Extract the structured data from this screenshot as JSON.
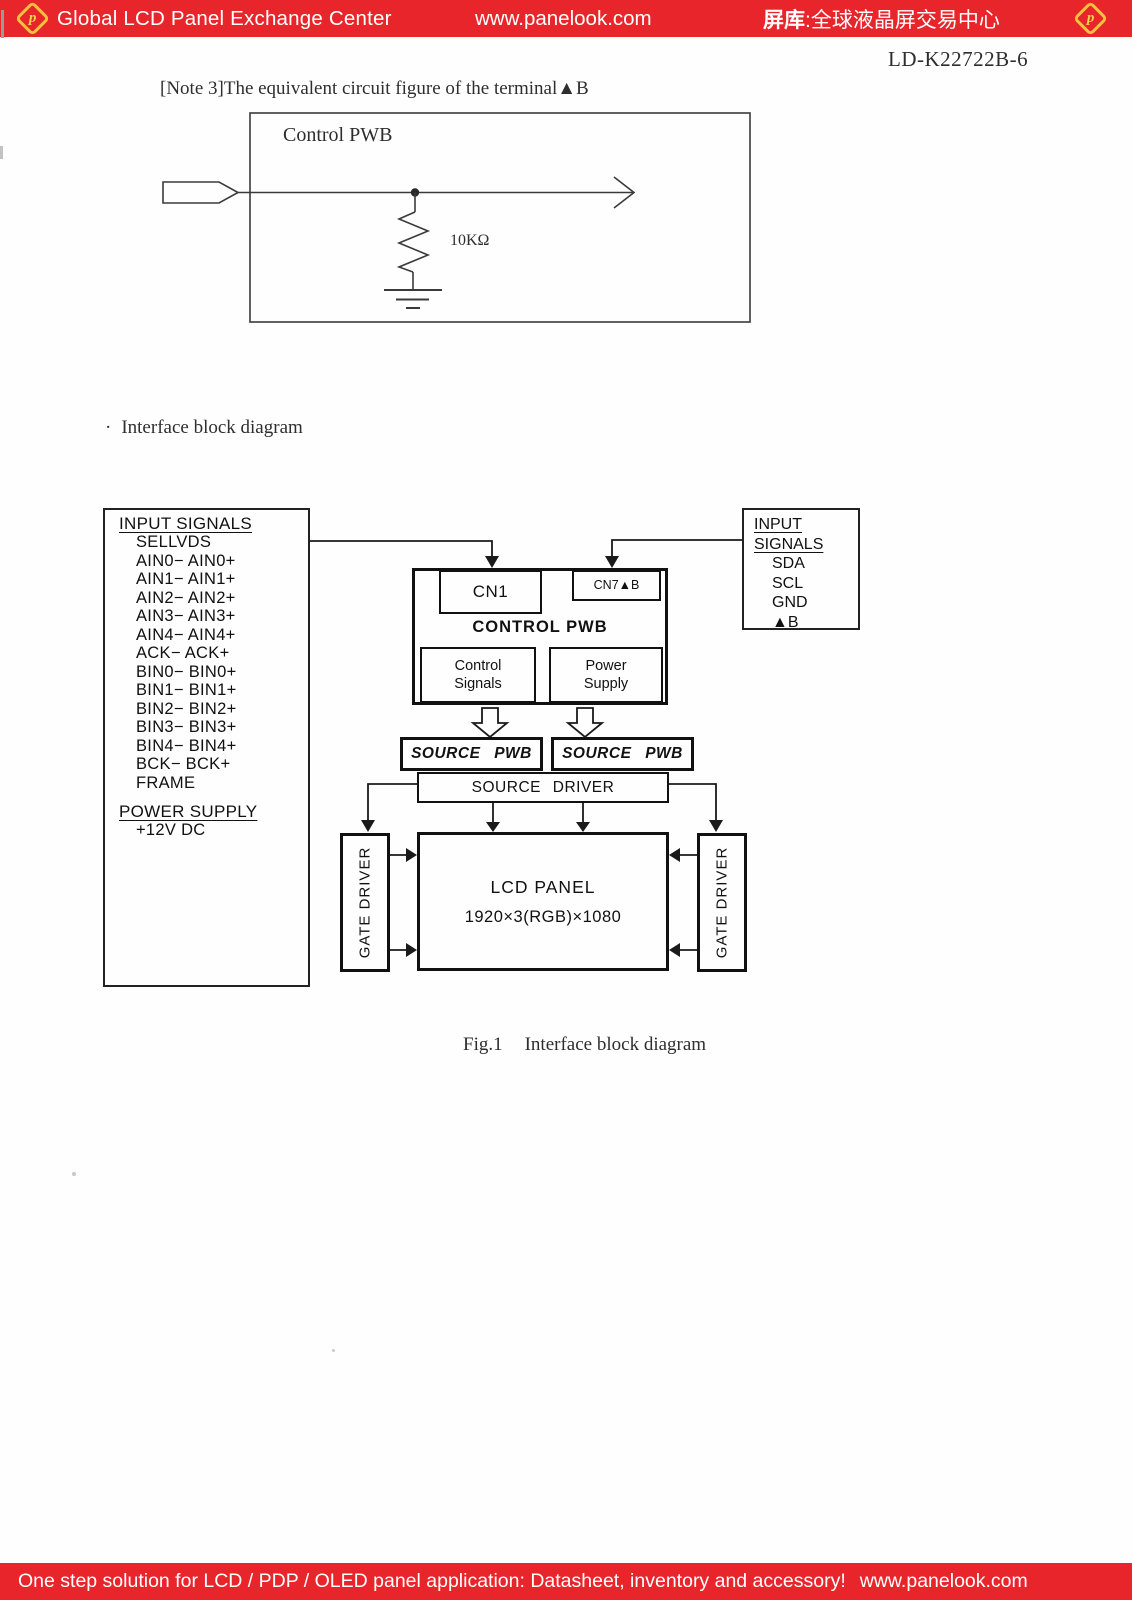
{
  "header": {
    "brand": "Global LCD Panel Exchange Center",
    "url": "www.panelook.com",
    "cn_bold": "屏库",
    "cn_rest": ":全球液晶屏交易中心",
    "logo_letter": "p",
    "bg_color": "#e8252b"
  },
  "doc_number": "LD-K22722B-6",
  "note_text": "[Note 3]The equivalent circuit figure of the terminal▲B",
  "equiv_circuit": {
    "board_label": "Control PWB",
    "terminal_label": "Terminal",
    "resistor_value": "10KΩ"
  },
  "section": {
    "bullet": "·",
    "title": "Interface block diagram"
  },
  "block_diagram": {
    "left_panel": {
      "heading": "INPUT SIGNALS",
      "signals": [
        "SELLVDS",
        "AIN0− AIN0+",
        "AIN1− AIN1+",
        "AIN2− AIN2+",
        "AIN3− AIN3+",
        "AIN4− AIN4+",
        "ACK− ACK+",
        "BIN0− BIN0+",
        "BIN1− BIN1+",
        "BIN2− BIN2+",
        "BIN3− BIN3+",
        "BIN4− BIN4+",
        "BCK− BCK+",
        "FRAME"
      ],
      "power_heading": "POWER SUPPLY",
      "power_value": "+12V DC"
    },
    "right_panel": {
      "heading_line1": "INPUT",
      "heading_line2": "SIGNALS",
      "signals": [
        "SDA",
        "SCL",
        "GND",
        "▲B"
      ]
    },
    "control_pwb": {
      "title": "CONTROL PWB",
      "cn1": "CN1",
      "cn7": "CN7▲B",
      "control_signals_line1": "Control",
      "control_signals_line2": "Signals",
      "power_supply_line1": "Power",
      "power_supply_line2": "Supply"
    },
    "source_pwb_left": "SOURCE PWB",
    "source_pwb_right": "SOURCE PWB",
    "source_driver": "SOURCE DRIVER",
    "lcd_panel": {
      "line1": "LCD PANEL",
      "line2": "1920×3(RGB)×1080"
    },
    "gate_driver_left": "GATE DRIVER",
    "gate_driver_right": "GATE DRIVER"
  },
  "caption": {
    "fig": "Fig.1",
    "text": "Interface block diagram"
  },
  "footer": {
    "text": "One step solution for LCD / PDP / OLED panel application: Datasheet, inventory and accessory!",
    "url": "www.panelook.com"
  }
}
